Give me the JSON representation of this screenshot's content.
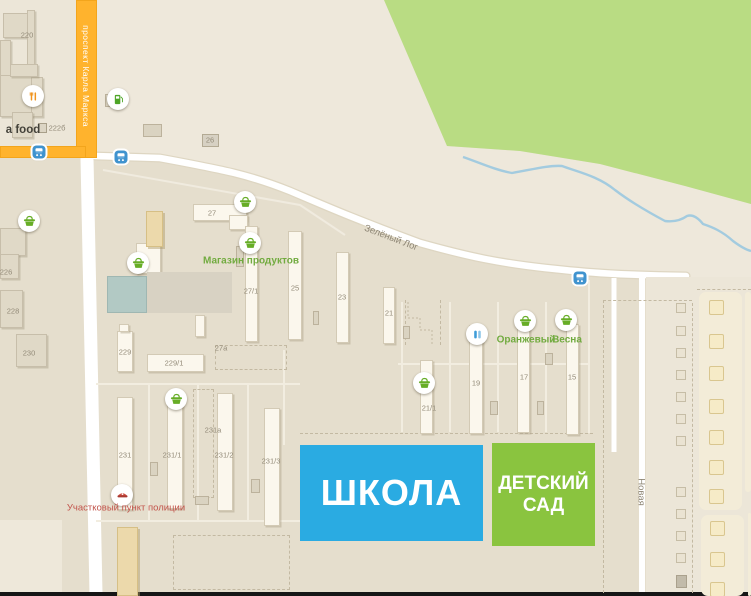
{
  "colors": {
    "background": "#e5decd",
    "park_green": "#b9dc83",
    "river_blue": "#a3cbdf",
    "road_major_orange": "#ffb32d",
    "road_white": "#ffffff",
    "school_blue": "#2aabe2",
    "kindergarten_green": "#8ac43f",
    "shop_label_green": "#72ab40",
    "police_label_red": "#c2544b",
    "basket_icon_green": "#67ad27",
    "bus_icon_blue": "#3f93cf"
  },
  "streets": {
    "karl_marx": "проспект Карла Маркса",
    "zeleny_log": "Зелёный Лог",
    "novaya": "Новая"
  },
  "landmarks": {
    "school": "ШКОЛА",
    "kindergarten_line1": "ДЕТСКИЙ",
    "kindergarten_line2": "САД"
  },
  "geometry": {
    "light_rects": [
      {
        "x": 0,
        "y": 0,
        "w": 76,
        "h": 146,
        "cls": "lightrect"
      },
      {
        "x": 646,
        "y": 277,
        "w": 105,
        "h": 315,
        "cls": "lightrect"
      },
      {
        "x": 0,
        "y": 520,
        "w": 62,
        "h": 72,
        "cls": "lightrect2"
      }
    ],
    "roads_major": [
      {
        "x": 76,
        "y": 0,
        "w": 21,
        "h": 158
      },
      {
        "x": 0,
        "y": 146,
        "w": 86,
        "h": 12
      }
    ],
    "buildings": [
      {
        "x": 3,
        "y": 13,
        "w": 30,
        "h": 25,
        "k": "b-gray"
      },
      {
        "x": 27,
        "y": 10,
        "w": 8,
        "h": 57,
        "k": "b-gray"
      },
      {
        "x": 0,
        "y": 40,
        "w": 11,
        "h": 38,
        "k": "b-gray"
      },
      {
        "x": 0,
        "y": 75,
        "w": 32,
        "h": 42,
        "k": "b-gray"
      },
      {
        "x": 31,
        "y": 77,
        "w": 12,
        "h": 40,
        "k": "b-gray"
      },
      {
        "x": 12,
        "y": 112,
        "w": 21,
        "h": 26,
        "k": "b-gray"
      },
      {
        "x": 10,
        "y": 64,
        "w": 28,
        "h": 13,
        "k": "b-gray"
      },
      {
        "x": 0,
        "y": 228,
        "w": 26,
        "h": 28,
        "k": "b-gray"
      },
      {
        "x": 0,
        "y": 254,
        "w": 19,
        "h": 25,
        "k": "b-gray"
      },
      {
        "x": 0,
        "y": 290,
        "w": 23,
        "h": 38,
        "k": "b-gray"
      },
      {
        "x": 16,
        "y": 334,
        "w": 31,
        "h": 33,
        "k": "b-gray"
      },
      {
        "x": 193,
        "y": 204,
        "w": 54,
        "h": 17,
        "k": "b-white"
      },
      {
        "x": 229,
        "y": 215,
        "w": 19,
        "h": 15,
        "k": "b-white"
      },
      {
        "x": 245,
        "y": 226,
        "w": 13,
        "h": 116,
        "k": "b-white"
      },
      {
        "x": 288,
        "y": 231,
        "w": 14,
        "h": 109,
        "k": "b-white"
      },
      {
        "x": 336,
        "y": 252,
        "w": 13,
        "h": 91,
        "k": "b-white"
      },
      {
        "x": 383,
        "y": 287,
        "w": 12,
        "h": 57,
        "k": "b-white"
      },
      {
        "x": 420,
        "y": 360,
        "w": 13,
        "h": 74,
        "k": "b-white"
      },
      {
        "x": 469,
        "y": 325,
        "w": 14,
        "h": 109,
        "k": "b-white"
      },
      {
        "x": 517,
        "y": 323,
        "w": 13,
        "h": 110,
        "k": "b-white"
      },
      {
        "x": 566,
        "y": 324,
        "w": 13,
        "h": 111,
        "k": "b-white"
      },
      {
        "x": 117,
        "y": 397,
        "w": 16,
        "h": 113,
        "k": "b-white"
      },
      {
        "x": 167,
        "y": 392,
        "w": 16,
        "h": 117,
        "k": "b-white"
      },
      {
        "x": 217,
        "y": 393,
        "w": 16,
        "h": 118,
        "k": "b-white"
      },
      {
        "x": 264,
        "y": 408,
        "w": 16,
        "h": 118,
        "k": "b-white"
      },
      {
        "x": 117,
        "y": 331,
        "w": 16,
        "h": 41,
        "k": "b-white"
      },
      {
        "x": 119,
        "y": 324,
        "w": 10,
        "h": 8,
        "k": "b-white"
      },
      {
        "x": 147,
        "y": 354,
        "w": 57,
        "h": 18,
        "k": "b-white"
      },
      {
        "x": 195,
        "y": 315,
        "w": 10,
        "h": 22,
        "k": "b-white"
      },
      {
        "x": 136,
        "y": 243,
        "w": 25,
        "h": 31,
        "k": "b-white"
      },
      {
        "x": 146,
        "y": 211,
        "w": 17,
        "h": 36,
        "k": "b-tan"
      },
      {
        "x": 117,
        "y": 527,
        "w": 21,
        "h": 69,
        "k": "b-tan"
      },
      {
        "x": 107,
        "y": 276,
        "w": 40,
        "h": 37,
        "k": "b-teal"
      },
      {
        "x": 147,
        "y": 272,
        "w": 85,
        "h": 41,
        "k": "b-slab"
      },
      {
        "x": 105,
        "y": 94,
        "w": 7,
        "h": 13,
        "k": "b-g"
      },
      {
        "x": 143,
        "y": 124,
        "w": 19,
        "h": 13,
        "k": "b-g"
      },
      {
        "x": 236,
        "y": 246,
        "w": 8,
        "h": 21,
        "k": "b-g"
      },
      {
        "x": 150,
        "y": 462,
        "w": 8,
        "h": 14,
        "k": "b-g"
      },
      {
        "x": 251,
        "y": 479,
        "w": 9,
        "h": 14,
        "k": "b-g"
      },
      {
        "x": 313,
        "y": 311,
        "w": 6,
        "h": 14,
        "k": "b-g"
      },
      {
        "x": 403,
        "y": 326,
        "w": 7,
        "h": 13,
        "k": "b-g"
      },
      {
        "x": 490,
        "y": 401,
        "w": 8,
        "h": 14,
        "k": "b-g"
      },
      {
        "x": 537,
        "y": 401,
        "w": 7,
        "h": 14,
        "k": "b-g"
      },
      {
        "x": 195,
        "y": 496,
        "w": 14,
        "h": 9,
        "k": "b-g"
      },
      {
        "x": 545,
        "y": 353,
        "w": 8,
        "h": 12,
        "k": "b-g"
      },
      {
        "x": 202,
        "y": 134,
        "w": 17,
        "h": 13,
        "k": "b-badge"
      }
    ],
    "lot_lines": [
      {
        "x": 398,
        "y": 363,
        "w": 192,
        "h": 2
      },
      {
        "x": 401,
        "y": 302,
        "w": 2,
        "h": 130
      },
      {
        "x": 449,
        "y": 302,
        "w": 2,
        "h": 130
      },
      {
        "x": 497,
        "y": 302,
        "w": 2,
        "h": 130
      },
      {
        "x": 545,
        "y": 302,
        "w": 2,
        "h": 130
      },
      {
        "x": 588,
        "y": 280,
        "w": 2,
        "h": 153
      },
      {
        "x": 96,
        "y": 383,
        "w": 204,
        "h": 2
      },
      {
        "x": 96,
        "y": 520,
        "w": 204,
        "h": 2
      },
      {
        "x": 148,
        "y": 385,
        "w": 2,
        "h": 135
      },
      {
        "x": 197,
        "y": 385,
        "w": 2,
        "h": 135
      },
      {
        "x": 247,
        "y": 385,
        "w": 2,
        "h": 135
      },
      {
        "x": 283,
        "y": 350,
        "w": 2,
        "h": 95
      }
    ],
    "dashes": [
      {
        "x": 193,
        "y": 389,
        "w": 21,
        "h": 109,
        "cls": "dash-r"
      },
      {
        "x": 215,
        "y": 345,
        "w": 72,
        "h": 25,
        "cls": "dash-r"
      },
      {
        "x": 173,
        "y": 535,
        "w": 117,
        "h": 55,
        "cls": "dash-r"
      },
      {
        "x": 603,
        "y": 300,
        "w": 1,
        "h": 293,
        "cls": "dash-v"
      },
      {
        "x": 692,
        "y": 303,
        "w": 1,
        "h": 290,
        "cls": "dash-v"
      },
      {
        "x": 603,
        "y": 300,
        "w": 89,
        "h": 1,
        "cls": "dash-h"
      },
      {
        "x": 697,
        "y": 289,
        "w": 54,
        "h": 1,
        "cls": "dash-h"
      },
      {
        "x": 300,
        "y": 433,
        "w": 293,
        "h": 1,
        "cls": "dash-h"
      },
      {
        "x": 405,
        "y": 300,
        "w": 1,
        "h": 45,
        "cls": "dash-v"
      },
      {
        "x": 440,
        "y": 300,
        "w": 1,
        "h": 45,
        "cls": "dash-v"
      }
    ],
    "garage_outlines": [
      {
        "x": 676,
        "y": 303
      },
      {
        "x": 676,
        "y": 326
      },
      {
        "x": 676,
        "y": 348
      },
      {
        "x": 676,
        "y": 370
      },
      {
        "x": 676,
        "y": 392
      },
      {
        "x": 676,
        "y": 414
      },
      {
        "x": 676,
        "y": 436
      },
      {
        "x": 676,
        "y": 487
      },
      {
        "x": 676,
        "y": 509
      },
      {
        "x": 676,
        "y": 531
      },
      {
        "x": 676,
        "y": 553
      }
    ],
    "garage_gray": [
      {
        "x": 676,
        "y": 575,
        "w": 11,
        "h": 13
      }
    ],
    "containers": [
      {
        "x": 699,
        "y": 292,
        "w": 43,
        "h": 218,
        "squares": [
          [
            709,
            300
          ],
          [
            709,
            334
          ],
          [
            709,
            366
          ],
          [
            709,
            399
          ],
          [
            709,
            430
          ],
          [
            709,
            460
          ],
          [
            709,
            489
          ]
        ]
      },
      {
        "x": 745,
        "y": 292,
        "w": 6,
        "h": 200,
        "squares": []
      },
      {
        "x": 701,
        "y": 515,
        "w": 43,
        "h": 81,
        "squares": [
          [
            710,
            521
          ],
          [
            710,
            552
          ],
          [
            710,
            582
          ]
        ]
      },
      {
        "x": 748,
        "y": 513,
        "w": 3,
        "h": 83,
        "squares": []
      }
    ],
    "icons": [
      {
        "t": "basket",
        "x": 29,
        "y": 221
      },
      {
        "t": "basket",
        "x": 138,
        "y": 263
      },
      {
        "t": "basket",
        "x": 245,
        "y": 202
      },
      {
        "t": "basket",
        "x": 250,
        "y": 243
      },
      {
        "t": "basket",
        "x": 176,
        "y": 399
      },
      {
        "t": "basket",
        "x": 424,
        "y": 383
      },
      {
        "t": "basket",
        "x": 525,
        "y": 321
      },
      {
        "t": "basket",
        "x": 566,
        "y": 320
      },
      {
        "t": "fuel",
        "x": 118,
        "y": 99
      },
      {
        "t": "food",
        "x": 33,
        "y": 96
      },
      {
        "t": "police",
        "x": 122,
        "y": 495
      },
      {
        "t": "bluepoi",
        "x": 477,
        "y": 334
      }
    ],
    "bus_stops": [
      {
        "x": 39,
        "y": 152
      },
      {
        "x": 121,
        "y": 157
      },
      {
        "x": 580,
        "y": 278
      }
    ],
    "minihouse": {
      "x": 42,
      "y": 128
    },
    "labels": [
      {
        "t": "220",
        "x": 27,
        "y": 35,
        "k": "num"
      },
      {
        "t": "222б",
        "x": 57,
        "y": 128,
        "k": "num"
      },
      {
        "t": "226",
        "x": 6,
        "y": 272,
        "k": "num"
      },
      {
        "t": "228",
        "x": 13,
        "y": 311,
        "k": "num"
      },
      {
        "t": "230",
        "x": 29,
        "y": 353,
        "k": "num"
      },
      {
        "t": "26",
        "x": 210,
        "y": 140,
        "k": "num"
      },
      {
        "t": "27",
        "x": 212,
        "y": 213,
        "k": "num"
      },
      {
        "t": "27/1",
        "x": 251,
        "y": 291,
        "k": "num"
      },
      {
        "t": "25",
        "x": 295,
        "y": 288,
        "k": "num"
      },
      {
        "t": "23",
        "x": 342,
        "y": 297,
        "k": "num"
      },
      {
        "t": "21",
        "x": 389,
        "y": 313,
        "k": "num"
      },
      {
        "t": "27а",
        "x": 221,
        "y": 348,
        "k": "num"
      },
      {
        "t": "21/1",
        "x": 429,
        "y": 408,
        "k": "num"
      },
      {
        "t": "19",
        "x": 476,
        "y": 383,
        "k": "num"
      },
      {
        "t": "17",
        "x": 524,
        "y": 377,
        "k": "num"
      },
      {
        "t": "15",
        "x": 572,
        "y": 377,
        "k": "num"
      },
      {
        "t": "229",
        "x": 125,
        "y": 352,
        "k": "num"
      },
      {
        "t": "229/1",
        "x": 174,
        "y": 363,
        "k": "num"
      },
      {
        "t": "231",
        "x": 125,
        "y": 455,
        "k": "num"
      },
      {
        "t": "231/1",
        "x": 172,
        "y": 455,
        "k": "num"
      },
      {
        "t": "231а",
        "x": 213,
        "y": 430,
        "k": "num"
      },
      {
        "t": "231/2",
        "x": 224,
        "y": 455,
        "k": "num"
      },
      {
        "t": "231/3",
        "x": 271,
        "y": 461,
        "k": "num"
      },
      {
        "t": "Магазин продуктов",
        "x": 251,
        "y": 261,
        "k": "shop"
      },
      {
        "t": "Оранжевый",
        "x": 526,
        "y": 340,
        "k": "shop"
      },
      {
        "t": "Весна",
        "x": 567,
        "y": 340,
        "k": "shop"
      },
      {
        "t": "Участковый пункт полиции",
        "x": 126,
        "y": 508,
        "k": "police"
      },
      {
        "t": "a food",
        "x": 23,
        "y": 130,
        "k": "food"
      },
      {
        "t": "Зелёный Лог",
        "x": 391,
        "y": 238,
        "k": "street",
        "r": 21
      },
      {
        "t": "Новая",
        "x": 641,
        "y": 492,
        "k": "street",
        "r": 90
      },
      {
        "t": "проспект Карла Маркса",
        "x": 86,
        "y": 76,
        "k": "roadwhite",
        "r": 90
      }
    ]
  }
}
